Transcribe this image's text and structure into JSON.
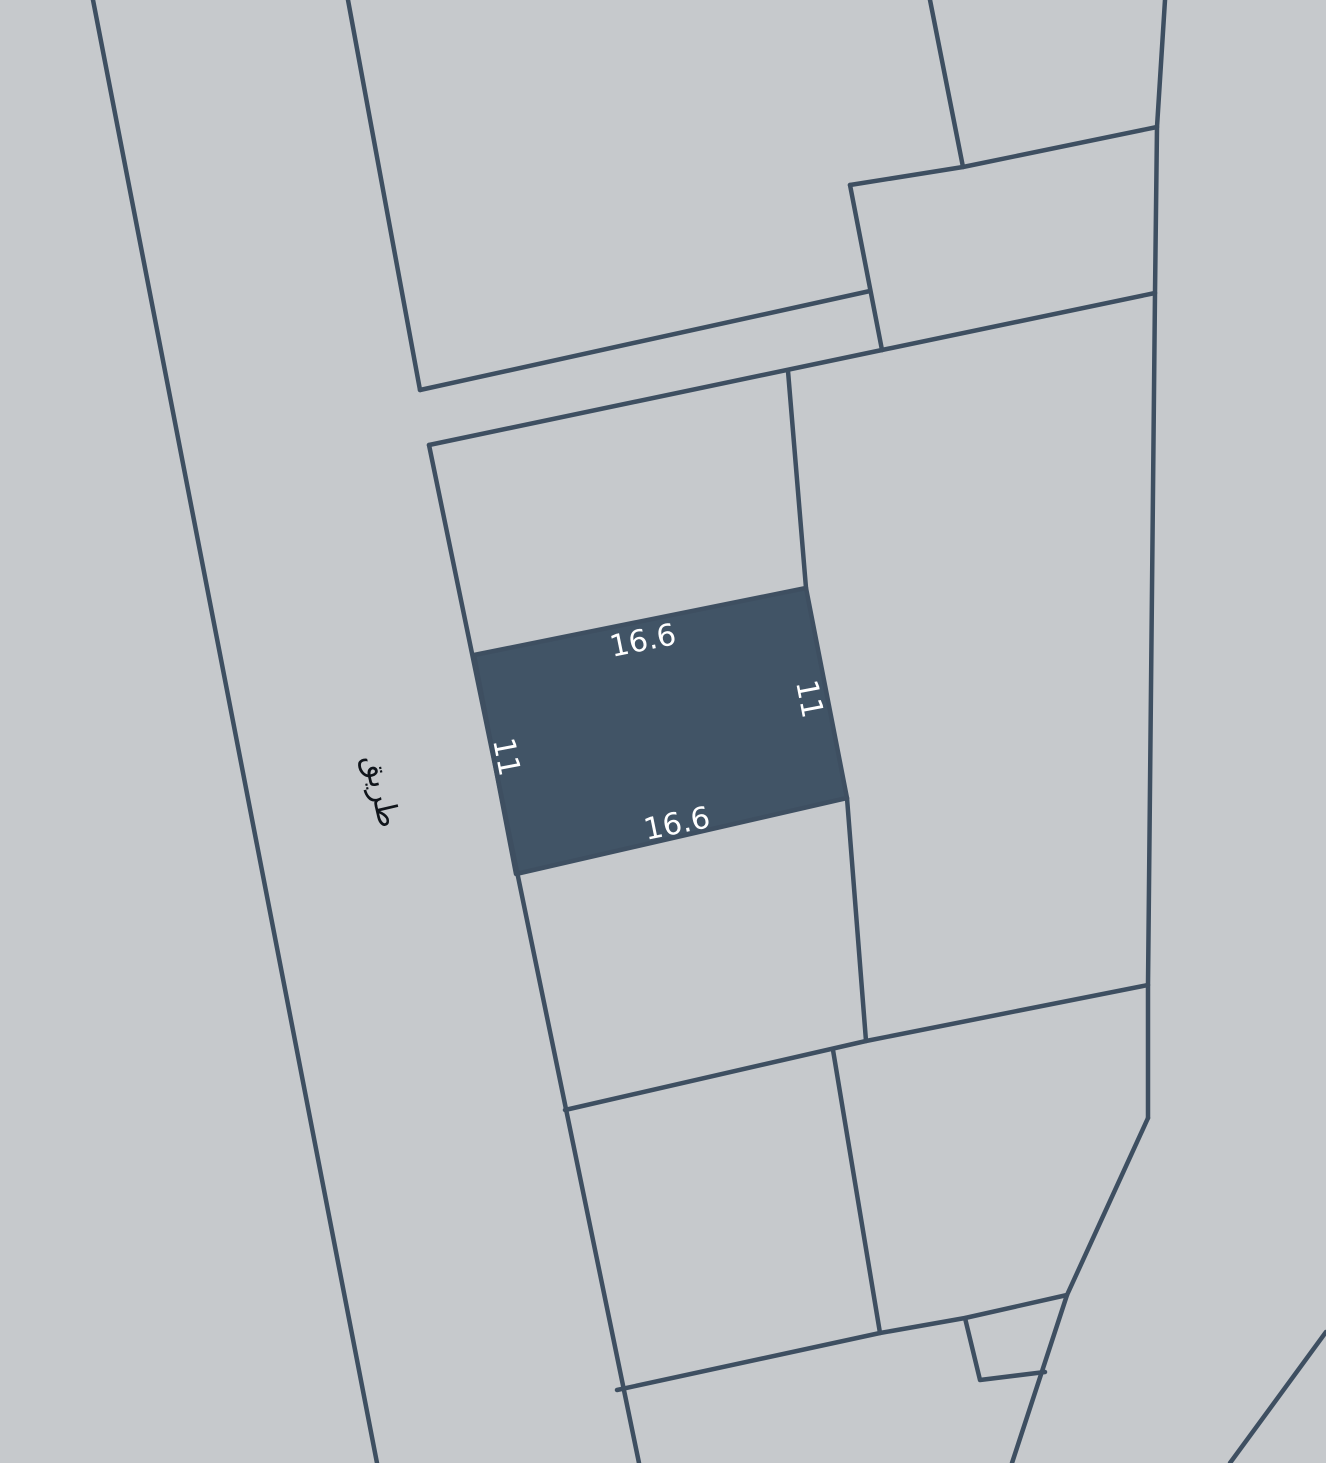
{
  "map": {
    "width": 1326,
    "height": 1463,
    "colors": {
      "background": "#c6c9cc",
      "boundary": "#3e4f61",
      "parcel_highlight": "#415466",
      "dimension_text": "#ffffff",
      "road_text": "#10151b"
    },
    "stroke_width": 4.5,
    "boundaries": [
      {
        "name": "road-west-edge",
        "points": [
          [
            93,
            0
          ],
          [
            377,
            1463
          ]
        ]
      },
      {
        "name": "road-east-edge-upper",
        "points": [
          [
            348,
            0
          ],
          [
            420,
            390
          ]
        ]
      },
      {
        "name": "sliver-upper-edge",
        "points": [
          [
            420,
            390
          ],
          [
            870,
            291
          ]
        ]
      },
      {
        "name": "north-parcel-top-edge",
        "points": [
          [
            429,
            445
          ],
          [
            882,
            350
          ]
        ]
      },
      {
        "name": "road-east-edge-lower",
        "points": [
          [
            429,
            445
          ],
          [
            639,
            1463
          ]
        ]
      },
      {
        "name": "upper-quad-west-edge",
        "points": [
          [
            850,
            185
          ],
          [
            882,
            350
          ]
        ]
      },
      {
        "name": "upper-quad-top-edge",
        "points": [
          [
            850,
            185
          ],
          [
            963,
            167
          ],
          [
            1157,
            127
          ]
        ]
      },
      {
        "name": "top-divider",
        "points": [
          [
            930,
            0
          ],
          [
            963,
            167
          ]
        ]
      },
      {
        "name": "east-boundary",
        "points": [
          [
            1165,
            0
          ],
          [
            1157,
            127
          ],
          [
            1155,
            293
          ],
          [
            1148,
            985
          ],
          [
            1148,
            1118
          ]
        ]
      },
      {
        "name": "upper-quad-bottom-edge",
        "points": [
          [
            882,
            350
          ],
          [
            1155,
            293
          ]
        ]
      },
      {
        "name": "north-parcel-east-edge",
        "points": [
          [
            788,
            371
          ],
          [
            806,
            588
          ]
        ]
      },
      {
        "name": "east-divider",
        "points": [
          [
            847,
            798
          ],
          [
            866,
            1041
          ]
        ]
      },
      {
        "name": "mid-diagonal",
        "points": [
          [
            565,
            1110
          ],
          [
            866,
            1041
          ],
          [
            1148,
            985
          ]
        ]
      },
      {
        "name": "south-divider",
        "points": [
          [
            833,
            1050
          ],
          [
            880,
            1333
          ]
        ]
      },
      {
        "name": "lower-diagonal",
        "points": [
          [
            617,
            1390
          ],
          [
            880,
            1333
          ],
          [
            965,
            1318
          ],
          [
            1067,
            1295
          ]
        ]
      },
      {
        "name": "southeast-boundary",
        "points": [
          [
            1148,
            1118
          ],
          [
            1067,
            1295
          ],
          [
            1012,
            1463
          ]
        ]
      },
      {
        "name": "small-parcel-edges",
        "points": [
          [
            965,
            1318
          ],
          [
            980,
            1380
          ],
          [
            1045,
            1372
          ]
        ]
      },
      {
        "name": "corner-diagonal",
        "points": [
          [
            1326,
            1332
          ],
          [
            1230,
            1463
          ]
        ]
      }
    ],
    "highlighted_parcel": {
      "name": "selected-parcel",
      "points": [
        [
          474,
          655
        ],
        [
          806,
          588
        ],
        [
          847,
          798
        ],
        [
          516,
          874
        ]
      ],
      "font_size": 30,
      "dimension_labels": [
        {
          "side": "top",
          "text": "16.6",
          "x": 643,
          "y": 641,
          "rotation": -11.5
        },
        {
          "side": "bottom",
          "text": "16.6",
          "x": 677,
          "y": 824,
          "rotation": -11.5
        },
        {
          "side": "right",
          "text": "11",
          "x": 809,
          "y": 699,
          "rotation": 79
        },
        {
          "side": "left",
          "text": "11",
          "x": 506,
          "y": 757,
          "rotation": 79
        }
      ]
    },
    "road_label": {
      "text": "طريق",
      "x": 381,
      "y": 791,
      "rotation": 77,
      "font_size": 30
    }
  }
}
